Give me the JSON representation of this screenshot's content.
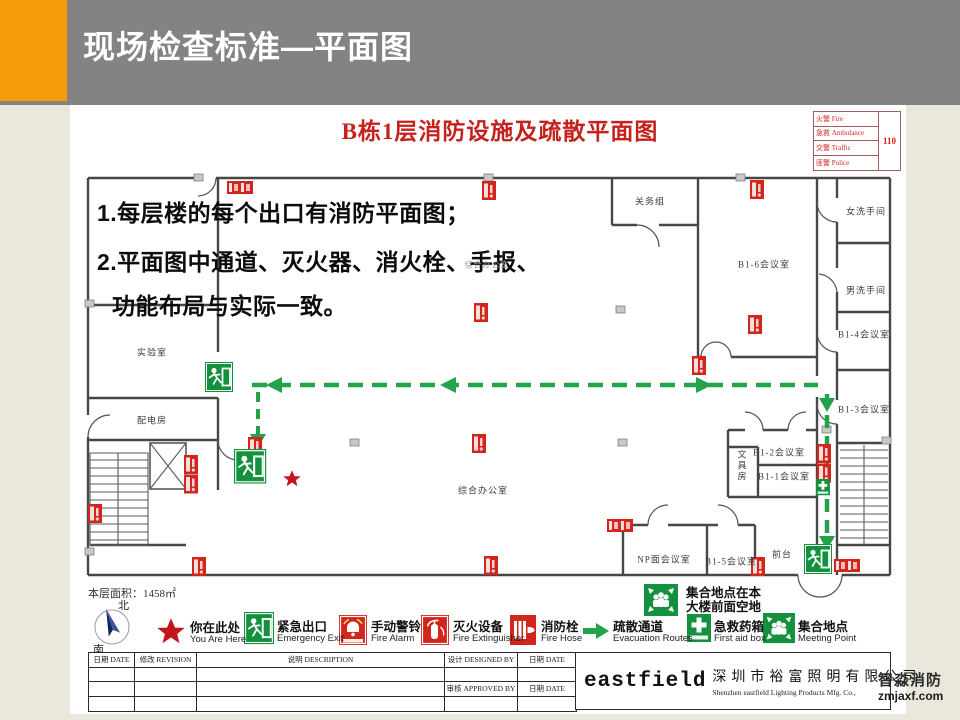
{
  "colors": {
    "accent_orange": "#F79A0C",
    "header_gray": "#838383",
    "title_red": "#C5211D",
    "icon_red": "#D2251C",
    "sign_green": "#13913F",
    "route_green": "#23A24A"
  },
  "header": {
    "title": "现场检查标准—平面图"
  },
  "plan": {
    "title": "B栋1层消防设施及疏散平面图",
    "emergency": {
      "rows": [
        "火警 Fire",
        "急救 Ambulance",
        "交警 Traffic",
        "匪警 Police"
      ],
      "number": "110"
    },
    "notes": {
      "line1": "1.每层楼的每个出口有消防平面图；",
      "line2": "2.平面图中通道、灭火器、消火栓、手报、",
      "line3": "功能布局与实际一致。"
    },
    "rooms": {
      "lab": "实验室",
      "power": "配电房",
      "customs": "关务组",
      "b16": "B1-6会议室",
      "wc_w": "女洗手间",
      "wc_m": "男洗手间",
      "b14": "B1-4会议室",
      "b13": "B1-3会议室",
      "b12": "B1-2会议室",
      "b11": "B1-1会议室",
      "stationery": "文具房",
      "np": "NP面会议室",
      "b15": "B1-5会议室",
      "front": "前台",
      "office": "综合办公室",
      "office_small": "综合办公室"
    },
    "area_text": "本层面积：1458㎡",
    "compass": {
      "north": "北",
      "south": "南"
    }
  },
  "legend": {
    "items": [
      {
        "cn": "你在此处",
        "en": "You Are Here"
      },
      {
        "cn": "紧急出口",
        "en": "Emergency Exit"
      },
      {
        "cn": "手动警铃",
        "en": "Fire Alarm"
      },
      {
        "cn": "灭火设备",
        "en": "Fire Extinguisher"
      },
      {
        "cn": "消防栓",
        "en": "Fire Hose"
      },
      {
        "cn": "疏散通道",
        "en": "Evacuation Routes"
      },
      {
        "cn": "急救药箱",
        "en": "First aid box"
      },
      {
        "cn": "集合地点",
        "en": "Meeting Point"
      }
    ],
    "meeting_note": {
      "line1": "集合地点在本",
      "line2": "大楼前面空地"
    }
  },
  "footer": {
    "date1": "日期 DATE",
    "revision": "修改 REVISION",
    "description": "说明 DESCRIPTION",
    "designed": "设计 DESIGNED BY",
    "date2": "日期 DATE",
    "approved": "审核 APPROVED BY",
    "date3": "日期 DATE"
  },
  "company": {
    "logo": "eastfield",
    "name_cn": "深圳市裕富照明有限公司",
    "name_en": "Shenzhen eastfield Lighting Products Mfg. Co.,"
  },
  "watermark": {
    "name": "智淼消防",
    "url": "zmjaxf.com"
  }
}
